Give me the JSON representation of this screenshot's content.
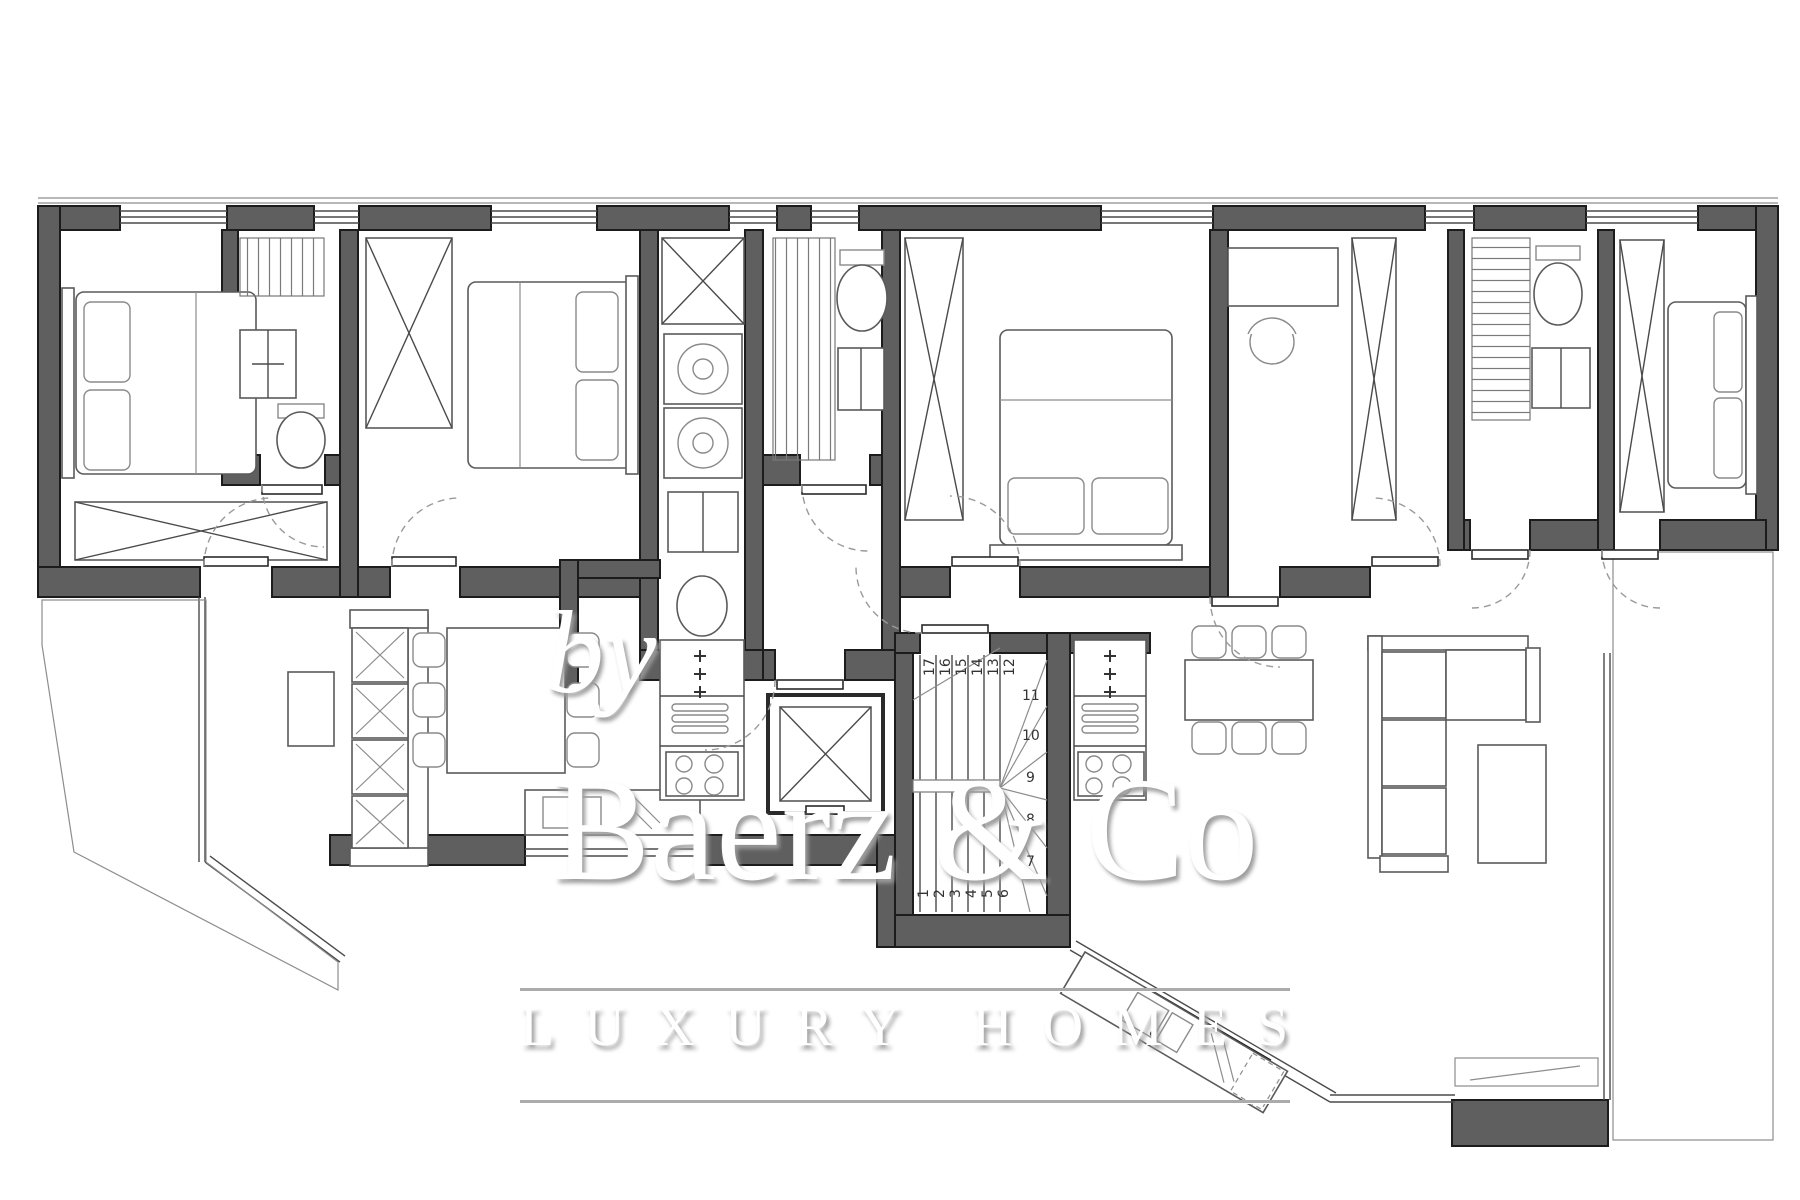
{
  "watermark": {
    "by": "by",
    "brand": "Baerz & Co",
    "tagline": "LUXURY HOMES"
  },
  "stairs": {
    "numbers": [
      "1",
      "2",
      "3",
      "4",
      "5",
      "6",
      "7",
      "8",
      "9",
      "10",
      "11",
      "12",
      "13",
      "14",
      "15",
      "16",
      "17"
    ]
  },
  "colors": {
    "wall_fill": "#5f5f5f",
    "wall_outline": "#1c1c1c",
    "thin_line": "#4a4a4a",
    "door_arc": "#9a9a9a",
    "watermark_text": "#ffffff",
    "watermark_shadow": "#9c9c9c",
    "background": "#ffffff"
  }
}
